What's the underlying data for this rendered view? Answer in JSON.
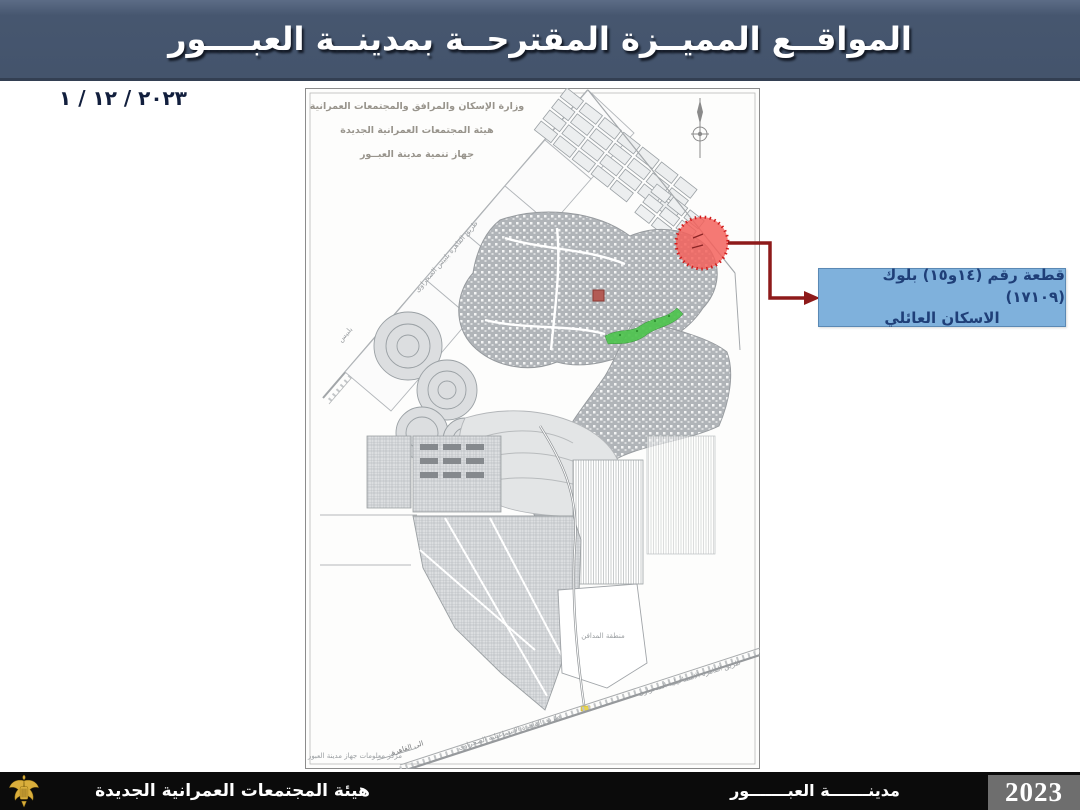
{
  "header": {
    "title": "المواقــع المميــزة المقترحــة بمدينــة العبــــور"
  },
  "date_label": "٢٠٢٣ / ١٢ / ١",
  "map": {
    "ministry_line1": "وزارة الإسكان والمرافق والمجتمعات العمرانية",
    "ministry_line2": "هيئة المجتمعات العمرانية الجديدة",
    "ministry_line3": "جهاز تنمية مدينة العبــور",
    "label_road_belbeis": "طريق القاهرة بلبيس الصحراوى",
    "label_belbeis": "بلبيس",
    "label_road_ismailia_a": "طريق القاهرة الاسماعيلية الصحراوى",
    "label_road_ismailia_b": "طريق القاهرة الاسماعيلية الصحراوى",
    "label_to_cairo": "الى القاهرة",
    "label_cemetery": "منطقة المدافن",
    "label_info_center": "مركز معلومات جهاز مدينة العبور"
  },
  "callout": {
    "line1": "قطعة رقم (١٤و١٥) بلوك (١٧١٠٩)",
    "line2": "الاسكان العائلي"
  },
  "footer": {
    "authority": "هيئة المجتمعات العمرانية الجديدة",
    "city": "مدينـــــــة العبـــــــور",
    "year": "2023"
  },
  "colors": {
    "header_bg": "#46566F",
    "callout_bg": "#7FB1DC",
    "callout_text": "#1F3F78",
    "arrow": "#8E1A1A",
    "circle_fill": "#F3625C",
    "circle_stroke": "#CF1D1D",
    "footer_bg": "#0B0B0B",
    "year_bg": "#6E6E6E",
    "park_green": "#4EC44E"
  }
}
